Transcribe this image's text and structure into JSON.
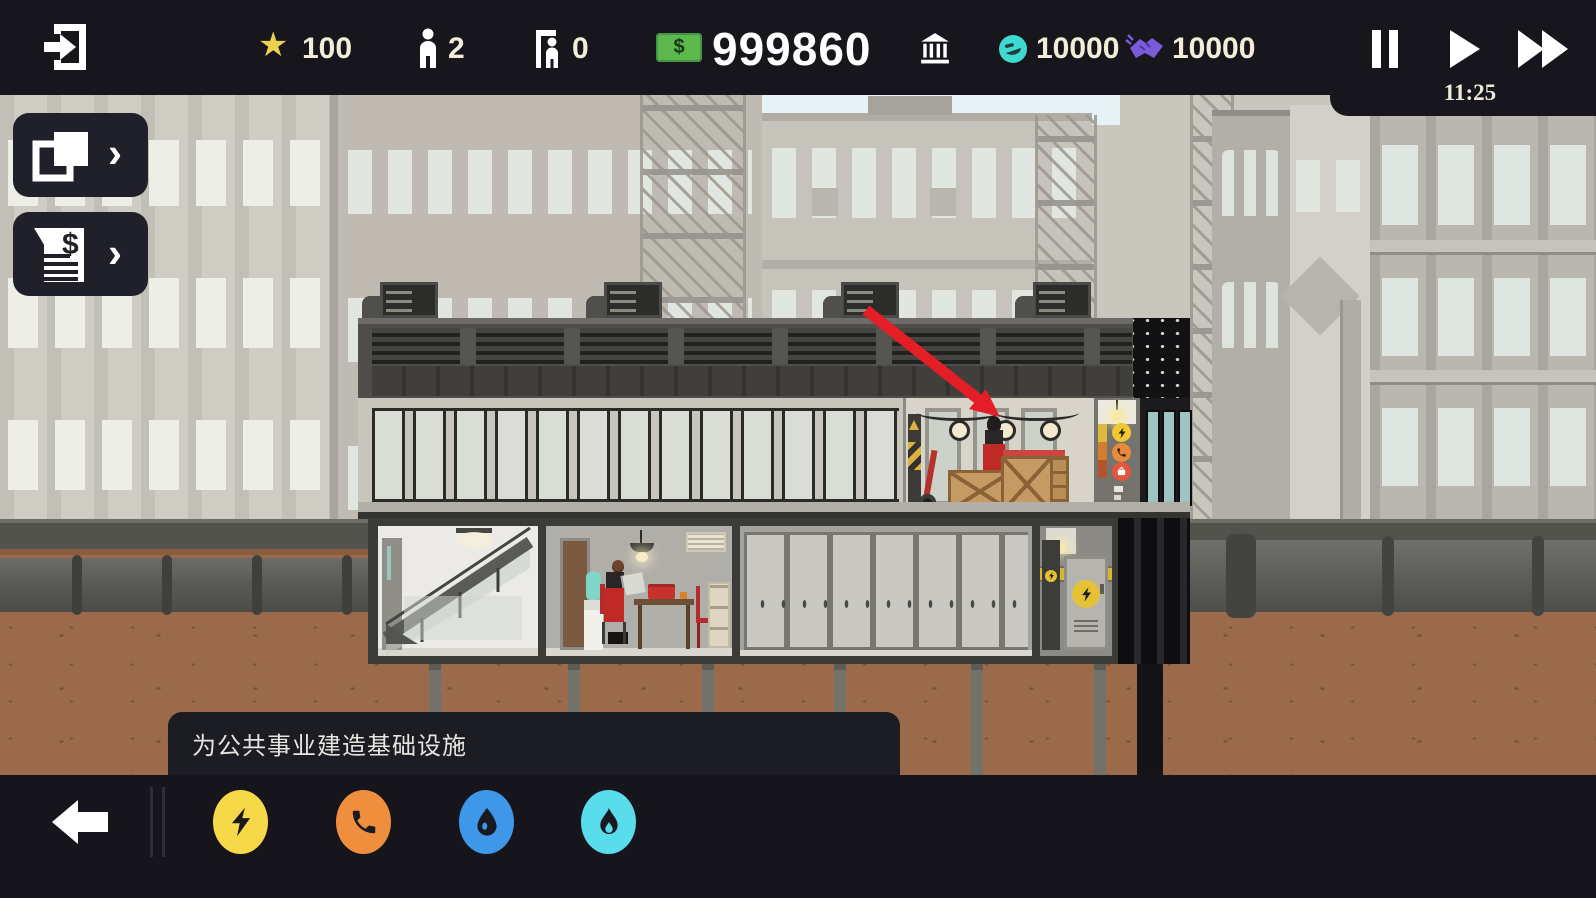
{
  "topbar": {
    "rating": "100",
    "population": "2",
    "visitors": "0",
    "money": "999860",
    "happiness": "10000",
    "contracts": "10000",
    "time": "11:25"
  },
  "tooltip": {
    "text": "为公共事业建造基础设施"
  },
  "icons": {
    "star": "★",
    "chevron": "›",
    "dollar": "$"
  },
  "palette": {
    "topbar_bg": "#16161c",
    "panel_bg": "#20202a",
    "money_green": "#5cb84c",
    "happiness_teal": "#3fd9d2",
    "contracts_purple": "#7a5bd9",
    "electricity_yellow": "#f6d848",
    "phone_orange": "#ef8f3d",
    "water_blue": "#3e97e8",
    "gas_cyan": "#59dcec",
    "arrow_red": "#e41e26",
    "star_yellow": "#ecd04e"
  }
}
